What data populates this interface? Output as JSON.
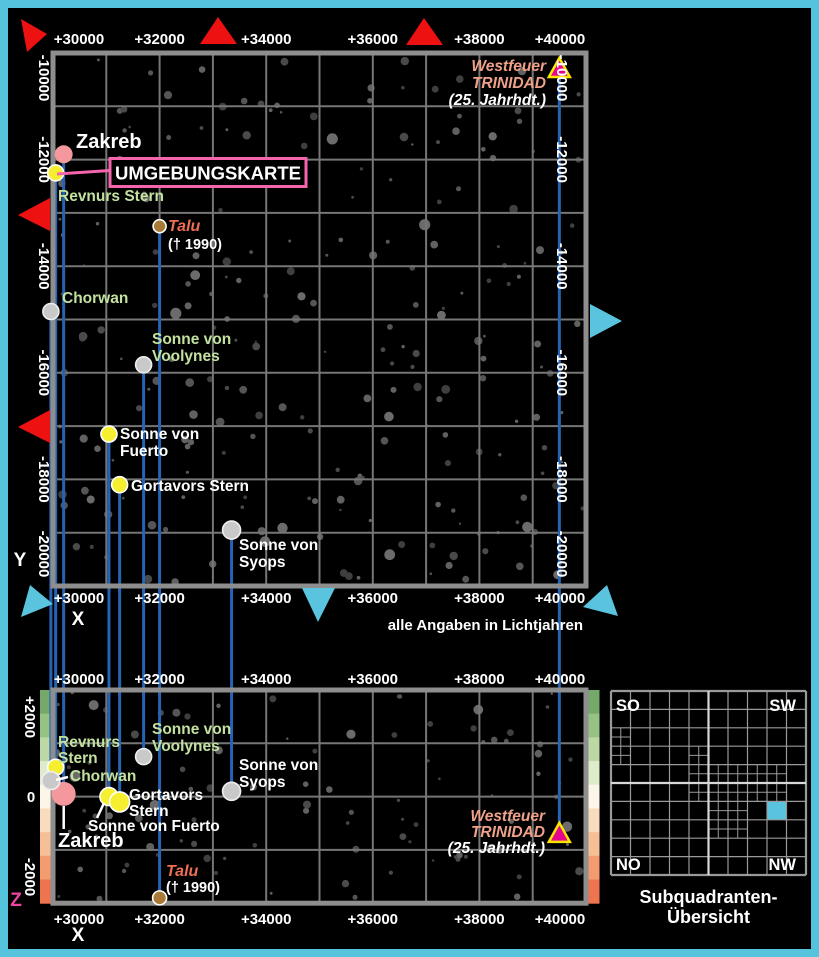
{
  "colors": {
    "page_border": "#56c3dd",
    "map_background": "#000000",
    "grid_line": "#767676",
    "map_frame": "#8e8e8e",
    "projection_line": "#2763b5",
    "label_green": "#c3e2a0",
    "label_salmon": "#efa189",
    "label_white": "#ffffff",
    "talu_label": "#ee6f52",
    "pink_accent": "#f565ae",
    "z_label_magenta": "#f0459f",
    "marker_red": "#ee1111",
    "marker_cyan": "#5ac4de",
    "westfeuer_triangle_fill": "#e5068f",
    "westfeuer_triangle_border": "#ffe600",
    "overview_line": "#9a9a9a",
    "overview_mid_line": "#d8d8d8",
    "overview_highlight": "#5ac4de"
  },
  "title_box": {
    "label": "UMGEBUNGSKARTE"
  },
  "annotation": {
    "units_note": "alle Angaben in Lichtjahren"
  },
  "axes": {
    "x_label": "X",
    "y_label": "Y",
    "z_label": "Z",
    "x_ticks": [
      "+30000",
      "+32000",
      "+34000",
      "+36000",
      "+38000",
      "+40000"
    ],
    "y_ticks": [
      "-10000",
      "-12000",
      "-14000",
      "-16000",
      "-18000",
      "-20000"
    ],
    "z_ticks": [
      "+2000",
      "0",
      "-2000"
    ],
    "x_range_lj": [
      30000,
      40000
    ],
    "y_range_lj": [
      -10000,
      -20000
    ],
    "z_range_lj": [
      2000,
      -2000
    ]
  },
  "elevation_scale": [
    "#74a96a",
    "#96c383",
    "#bcd8a4",
    "#dfeccb",
    "#fbf6e7",
    "#f9dcbd",
    "#f6bf96",
    "#f29c70",
    "#ee7450"
  ],
  "stars": [
    {
      "name": "Zakreb",
      "x": 30200,
      "y": -11900,
      "z": 50,
      "marker": "circle",
      "fill": "#f5989e",
      "stroke": "",
      "r_top": 9,
      "r_bottom": 12,
      "top_label": {
        "anchor": "start",
        "x": 76,
        "y": 148,
        "lh": 17,
        "lines": [
          {
            "t": "Zakreb",
            "c": "#ffffff",
            "s": 20
          }
        ]
      },
      "bottom_label": {
        "anchor": "start",
        "x": 58,
        "y": 847,
        "lh": 17,
        "lines": [
          {
            "t": "Zakreb",
            "c": "#ffffff",
            "s": 20
          }
        ]
      },
      "bottom_pointer": [
        63.7,
        806,
        63.7,
        829
      ]
    },
    {
      "name": "Revnurs Stern",
      "x": 30050,
      "y": -12250,
      "z": 550,
      "marker": "circle",
      "fill": "#f6ef2f",
      "stroke": "#ffffff",
      "r_top": 8,
      "r_bottom": 8,
      "top_label": {
        "anchor": "start",
        "x": 58,
        "y": 201,
        "lh": 16,
        "lines": [
          {
            "t": "Revnurs Stern",
            "c": "#c3e2a0"
          }
        ]
      },
      "bottom_label": {
        "anchor": "start",
        "x": 58,
        "y": 747,
        "lh": 16,
        "lines": [
          {
            "t": "Revnurs",
            "c": "#c3e2a0"
          },
          {
            "t": "Stern",
            "c": "#c3e2a0"
          }
        ]
      }
    },
    {
      "name": "Chorwan",
      "x": 29960,
      "y": -14850,
      "z": 300,
      "marker": "circle",
      "fill": "#c9c9c9",
      "stroke": "#eeeeee",
      "r_top": 8,
      "r_bottom": 9,
      "top_label": {
        "anchor": "start",
        "x": 62,
        "y": 303,
        "lh": 16,
        "lines": [
          {
            "t": "Chorwan",
            "c": "#c3e2a0"
          }
        ]
      },
      "bottom_label": {
        "anchor": "start",
        "x": 70,
        "y": 781,
        "lh": 16,
        "lines": [
          {
            "t": "Chorwan",
            "c": "#c3e2a0"
          }
        ]
      },
      "bottom_pointer": [
        56,
        780,
        68,
        777
      ]
    },
    {
      "name": "Talu",
      "x": 32000,
      "y": -13250,
      "z": -1900,
      "marker": "circle",
      "fill": "#a97a35",
      "stroke": "#ffffff",
      "r_top": 6.5,
      "r_bottom": 7,
      "top_label": {
        "anchor": "start",
        "x": 168,
        "y": 231,
        "lh": 18,
        "lines": [
          {
            "t": "Talu",
            "c": "#ee6f52",
            "s": 16,
            "i": true
          },
          {
            "t": "(† 1990)",
            "c": "#ffffff",
            "s": 14.5
          }
        ]
      },
      "bottom_label": {
        "anchor": "start",
        "x": 166,
        "y": 876,
        "lh": 16,
        "lines": [
          {
            "t": "Talu",
            "c": "#ee6f52",
            "s": 16,
            "i": true
          },
          {
            "t": "(† 1990)",
            "c": "#ffffff",
            "s": 14.5
          }
        ]
      }
    },
    {
      "name": "Sonne von Voolynes",
      "x": 31700,
      "y": -15850,
      "z": 750,
      "marker": "circle",
      "fill": "#c9c9c9",
      "stroke": "#eeeeee",
      "r_top": 8,
      "r_bottom": 8,
      "top_label": {
        "anchor": "start",
        "x": 152,
        "y": 344,
        "lh": 17,
        "lines": [
          {
            "t": "Sonne von",
            "c": "#c3e2a0"
          },
          {
            "t": "Voolynes",
            "c": "#c3e2a0"
          }
        ]
      },
      "bottom_label": {
        "anchor": "start",
        "x": 152,
        "y": 734,
        "lh": 17,
        "lines": [
          {
            "t": "Sonne von",
            "c": "#c3e2a0"
          },
          {
            "t": "Voolynes",
            "c": "#c3e2a0"
          }
        ]
      }
    },
    {
      "name": "Sonne von Fuerto",
      "x": 31050,
      "y": -17150,
      "z": 0,
      "marker": "circle",
      "fill": "#f6ef2f",
      "stroke": "#ffffff",
      "r_top": 8,
      "r_bottom": 9,
      "top_label": {
        "anchor": "start",
        "x": 120,
        "y": 439,
        "lh": 17,
        "lines": [
          {
            "t": "Sonne von",
            "c": "#ffffff"
          },
          {
            "t": "Fuerto",
            "c": "#ffffff"
          }
        ]
      },
      "bottom_label": {
        "anchor": "start",
        "x": 88,
        "y": 831,
        "lh": 16,
        "lines": [
          {
            "t": "Sonne von Fuerto",
            "c": "#ffffff"
          }
        ]
      },
      "bottom_pointer": [
        104,
        803,
        97,
        818
      ]
    },
    {
      "name": "Gortavors Stern",
      "x": 31250,
      "y": -18100,
      "z": -100,
      "marker": "circle",
      "fill": "#f6ef2f",
      "stroke": "#ffffff",
      "r_top": 8,
      "r_bottom": 10,
      "top_label": {
        "anchor": "start",
        "x": 131,
        "y": 491,
        "lh": 16,
        "lines": [
          {
            "t": "Gortavors Stern",
            "c": "#ffffff"
          }
        ]
      },
      "bottom_label": {
        "anchor": "start",
        "x": 129,
        "y": 800,
        "lh": 16,
        "lines": [
          {
            "t": "Gortavors",
            "c": "#ffffff"
          },
          {
            "t": "Stern",
            "c": "#ffffff"
          }
        ]
      }
    },
    {
      "name": "Sonne von Syops",
      "x": 33350,
      "y": -18950,
      "z": 100,
      "marker": "circle",
      "fill": "#c9c9c9",
      "stroke": "#eeeeee",
      "r_top": 9,
      "r_bottom": 9,
      "top_label": {
        "anchor": "start",
        "x": 239,
        "y": 550,
        "lh": 17,
        "lines": [
          {
            "t": "Sonne von",
            "c": "#ffffff"
          },
          {
            "t": "Syops",
            "c": "#ffffff"
          }
        ]
      },
      "bottom_label": {
        "anchor": "start",
        "x": 239,
        "y": 770,
        "lh": 17,
        "lines": [
          {
            "t": "Sonne von",
            "c": "#ffffff"
          },
          {
            "t": "Syops",
            "c": "#ffffff"
          }
        ]
      }
    },
    {
      "name": "Westfeuer TRINIDAD",
      "x": 39500,
      "y": -10300,
      "z": -700,
      "marker": "triangle",
      "top_label": {
        "anchor": "end",
        "x": 546,
        "y": 71,
        "lh": 17,
        "lines": [
          {
            "t": "Westfeuer",
            "c": "#efa189",
            "i": true
          },
          {
            "t": "TRINIDAD",
            "c": "#efa189",
            "i": true
          },
          {
            "t": "(25. Jahrhdt.)",
            "c": "#ffffff",
            "i": true
          }
        ]
      },
      "bottom_label": {
        "anchor": "end",
        "x": 545,
        "y": 821,
        "lh": 16,
        "lines": [
          {
            "t": "Westfeuer",
            "c": "#efa189",
            "i": true
          },
          {
            "t": "TRINIDAD",
            "c": "#efa189",
            "i": true
          },
          {
            "t": "(25. Jahrhdt.)",
            "c": "#ffffff",
            "i": true
          }
        ]
      }
    }
  ],
  "direction_markers": [
    {
      "name": "red-top-left",
      "color": "#ee1111",
      "points": "21,19 47,34 27,52"
    },
    {
      "name": "red-top-center",
      "color": "#ee1111",
      "points": "200,44 218,17 237,44"
    },
    {
      "name": "red-top-right",
      "color": "#ee1111",
      "points": "406,45 424,18 443,45"
    },
    {
      "name": "red-left-upper",
      "color": "#ee1111",
      "points": "50,198 50,231 18,215"
    },
    {
      "name": "red-left-lower",
      "color": "#ee1111",
      "points": "50,410 50,443 18,427"
    },
    {
      "name": "cyan-right",
      "color": "#5ac4de",
      "points": "590,304 590,338 622,321"
    },
    {
      "name": "cyan-bottom-left",
      "color": "#5ac4de",
      "points": "30,585 53,604 21,617"
    },
    {
      "name": "cyan-bottom-center",
      "color": "#5ac4de",
      "points": "302,588 335,588 318,622"
    },
    {
      "name": "cyan-bottom-right",
      "color": "#5ac4de",
      "points": "607,585 618,616 583,607"
    }
  ],
  "overview": {
    "corners": {
      "top_left": "SO",
      "top_right": "SW",
      "bottom_left": "NO",
      "bottom_right": "NW"
    },
    "caption": [
      "Subquadranten-",
      "Übersicht"
    ],
    "grid_cols": 10,
    "grid_rows": 10,
    "subdivided_cells": [
      [
        0,
        2
      ],
      [
        0,
        3
      ],
      [
        4,
        3
      ],
      [
        4,
        4
      ],
      [
        5,
        4
      ],
      [
        6,
        4
      ],
      [
        7,
        4
      ],
      [
        8,
        4
      ],
      [
        4,
        5
      ],
      [
        5,
        5
      ],
      [
        6,
        5
      ],
      [
        7,
        5
      ],
      [
        8,
        5
      ],
      [
        5,
        6
      ],
      [
        6,
        6
      ],
      [
        5,
        7
      ],
      [
        6,
        7
      ]
    ],
    "highlight_cell": [
      8,
      6
    ]
  }
}
